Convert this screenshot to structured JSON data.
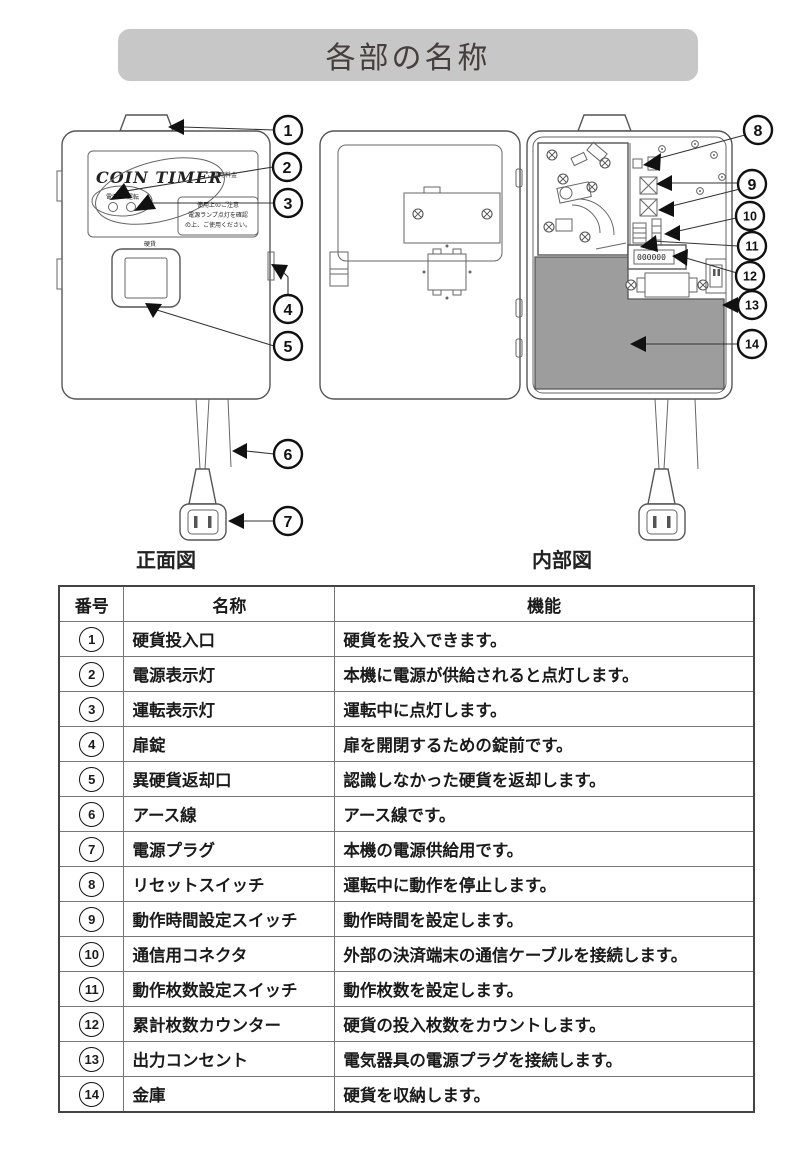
{
  "title": "各部の名称",
  "front_view": {
    "caption": "正面図",
    "logo": "COIN TIMER",
    "fee_label": "ご利用料金",
    "lamp_power": "電源",
    "lamp_run": "運転",
    "notice_title": "使用上のご注意",
    "notice_line1": "電源ランプ点灯を確認",
    "notice_line2": "の上、ご使用ください。",
    "slot_label": "硬貨"
  },
  "internal_view": {
    "caption": "内部図",
    "counter_display": "000000"
  },
  "table": {
    "headers": {
      "number": "番号",
      "name": "名称",
      "function": "機能"
    },
    "rows": [
      {
        "num": "1",
        "name": "硬貨投入口",
        "func": "硬貨を投入できます。"
      },
      {
        "num": "2",
        "name": "電源表示灯",
        "func": "本機に電源が供給されると点灯します。"
      },
      {
        "num": "3",
        "name": "運転表示灯",
        "func": "運転中に点灯します。"
      },
      {
        "num": "4",
        "name": "扉錠",
        "func": "扉を開閉するための錠前です。"
      },
      {
        "num": "5",
        "name": "異硬貨返却口",
        "func": "認識しなかった硬貨を返却します。"
      },
      {
        "num": "6",
        "name": "アース線",
        "func": "アース線です。"
      },
      {
        "num": "7",
        "name": "電源プラグ",
        "func": "本機の電源供給用です。"
      },
      {
        "num": "8",
        "name": "リセットスイッチ",
        "func": "運転中に動作を停止します。"
      },
      {
        "num": "9",
        "name": "動作時間設定スイッチ",
        "func": "動作時間を設定します。"
      },
      {
        "num": "10",
        "name": "通信用コネクタ",
        "func": "外部の決済端末の通信ケーブルを接続します。"
      },
      {
        "num": "11",
        "name": "動作枚数設定スイッチ",
        "func": "動作枚数を設定します。"
      },
      {
        "num": "12",
        "name": "累計枚数カウンター",
        "func": "硬貨の投入枚数をカウントします。"
      },
      {
        "num": "13",
        "name": "出力コンセント",
        "func": "電気器具の電源プラグを接続します。"
      },
      {
        "num": "14",
        "name": "金庫",
        "func": "硬貨を収納します。"
      }
    ]
  }
}
